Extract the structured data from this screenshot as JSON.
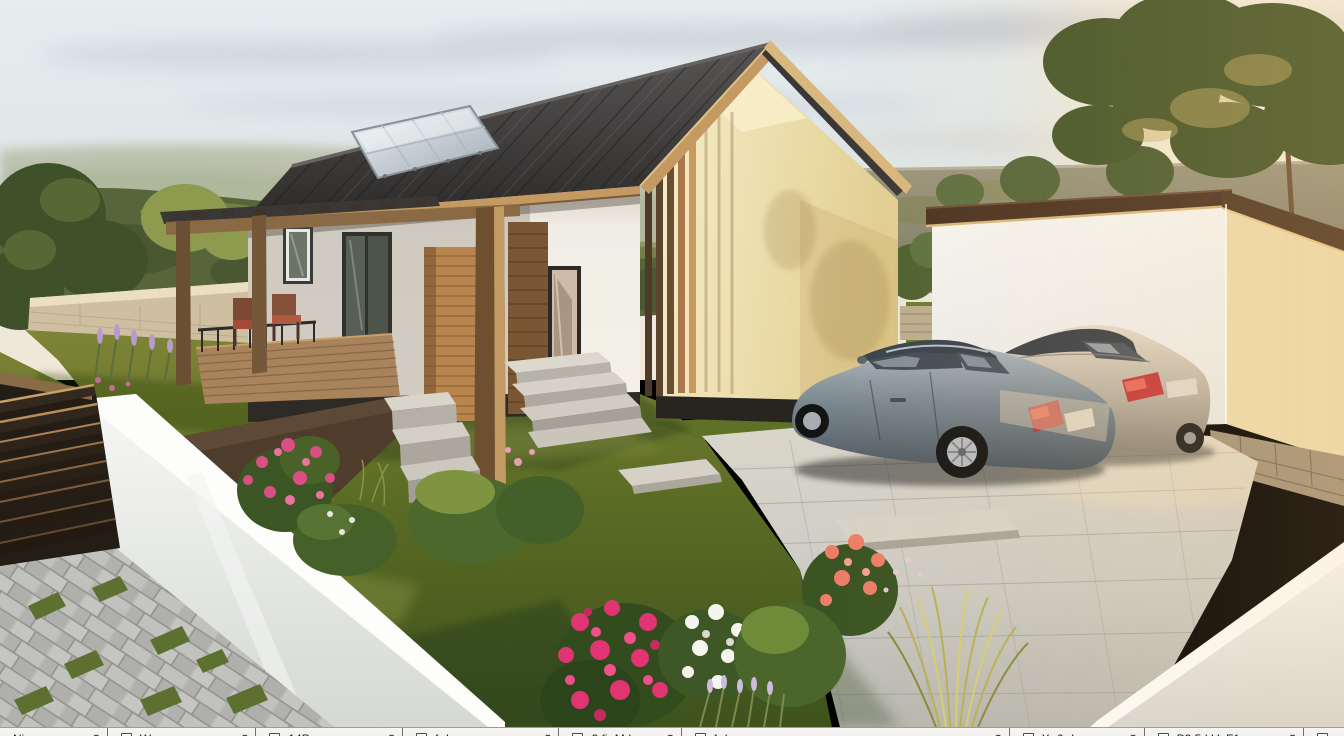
{
  "scene": {
    "palette": {
      "sky_top": "#e6edef",
      "sky_warm": "#f1e8d6",
      "sun_glow": "#fff6e0",
      "roof": "#3c3a39",
      "roof_fascia_wood": "#c49a62",
      "house_wall_white": "#f2efe8",
      "house_gable_cream": "#ecdfa8",
      "plinth_dark": "#2e2a26",
      "pergola_wood": "#8a6a45",
      "deck_wood": "#a8835b",
      "lawn_green": "#5e7026",
      "hedge_green": "#57663a",
      "stone_wall_beige": "#d9cdb2",
      "driveway_pavement": "#cfcec8",
      "paver_path_gray": "#b7b8b4",
      "boundary_wall_white": "#eceeec",
      "garage_roof_brown": "#4b3423",
      "car_front_silver_blue": "#7e8a92",
      "car_rear_champagne": "#cfc5b4",
      "taillight_red": "#c43a3a",
      "solar_panel": "#ccd5da",
      "rose_pink": "#e0457b",
      "rose_coral": "#e87a63",
      "rose_white": "#f3f1ea",
      "lavender_purple": "#8d6fae"
    }
  },
  "toolbar": {
    "background": "#f2f1ef",
    "border": "#9b9b9b",
    "divider": "#6f6f6f",
    "chevron": "▾",
    "segments": [
      {
        "label": "Ni"
      },
      {
        "label": "W"
      },
      {
        "label": "14P"
      },
      {
        "label": "f- I-"
      },
      {
        "label": "2 fi- M I-"
      },
      {
        "label": "f- I-"
      },
      {
        "label": "X- 0- I"
      },
      {
        "label": "P3 5 I V- F1"
      },
      {
        "label": ""
      }
    ]
  }
}
